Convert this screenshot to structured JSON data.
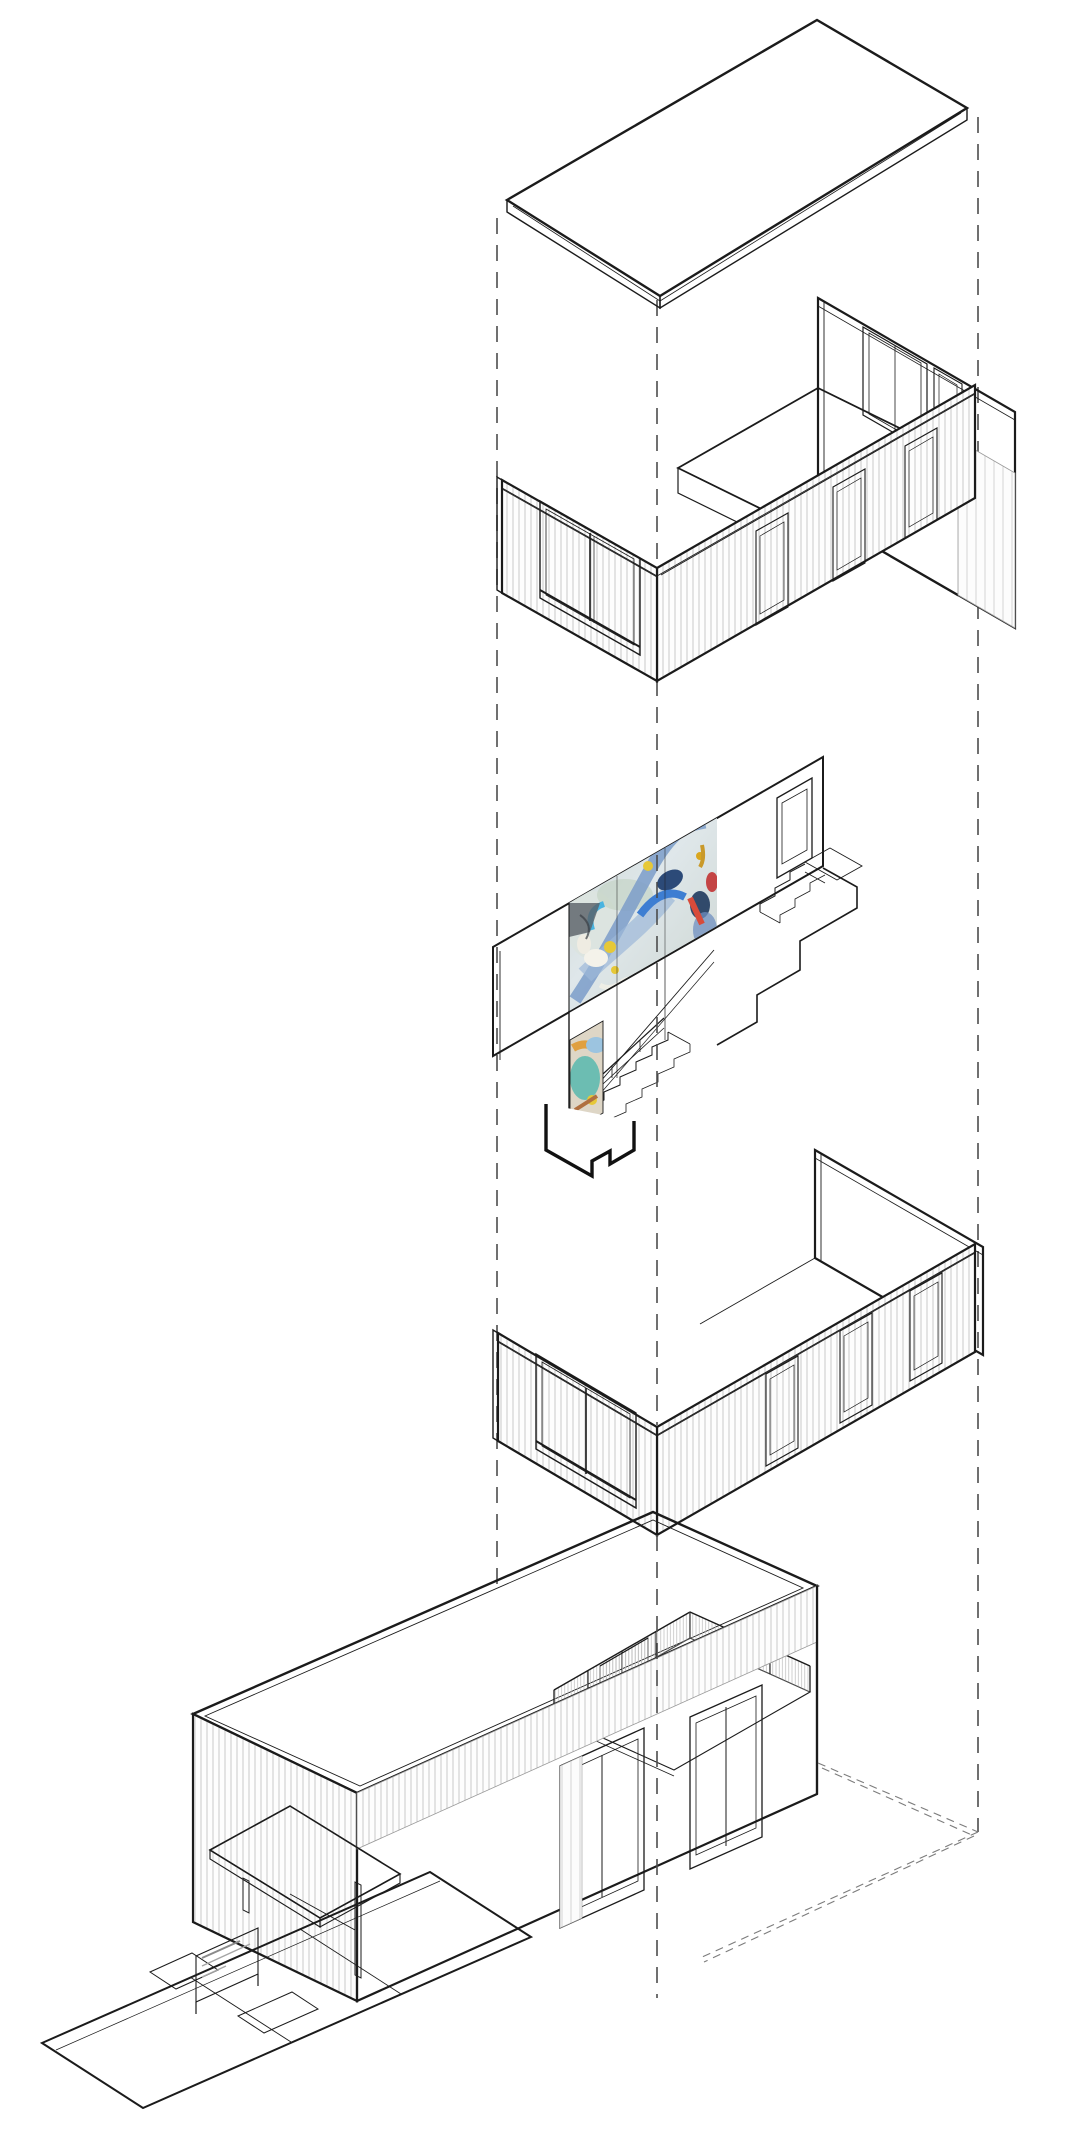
{
  "figure": {
    "title": "Exploded axonometric diagram of a two-storey house",
    "type": "architectural-exploded-axonometric",
    "layers": [
      {
        "id": "roof-slab",
        "label": "Flat roof slab"
      },
      {
        "id": "upper-walls",
        "label": "Upper storey walls with windows and door openings"
      },
      {
        "id": "mural-section",
        "label": "Interior stair section with painted mural wall"
      },
      {
        "id": "lower-walls",
        "label": "Lower storey walls with glazing"
      },
      {
        "id": "assembled-building",
        "label": "Assembled building with roof terrace, canopy and entry ramp"
      }
    ],
    "guides": {
      "count": 3,
      "style": "dashed vertical alignment lines"
    },
    "palette": {
      "line": "#1b1b1b",
      "light_line": "#9a9a9a",
      "siding_hatch": "#c9c9c9",
      "mural_blue": "#3e7ed2",
      "mural_steel": "#7b9cc9",
      "mural_navy": "#2c4a78",
      "mural_yellow": "#e6c838",
      "mural_magenta": "#c05a9c",
      "mural_red": "#d84b3a",
      "mural_teal": "#58b8ae",
      "mural_orange": "#e0a040",
      "background": "#ffffff"
    }
  }
}
